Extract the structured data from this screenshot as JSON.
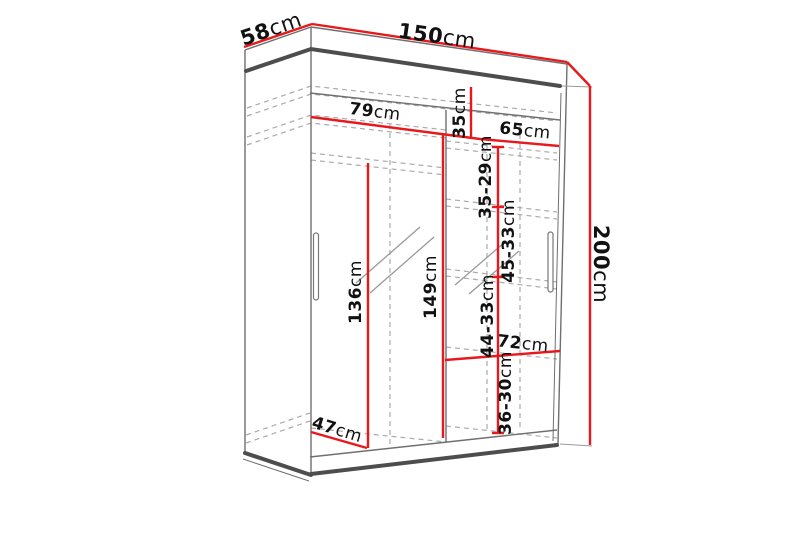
{
  "diagram": {
    "subject": "sliding-door wardrobe dimension drawing",
    "background": "#ffffff",
    "accent_color": "#e8191c",
    "line_color": "#6f6f6f",
    "unit": "cm",
    "dimensions": [
      {
        "id": "depth-top",
        "value": "58",
        "unit": "cm"
      },
      {
        "id": "width-top",
        "value": "150",
        "unit": "cm"
      },
      {
        "id": "height-right",
        "value": "200",
        "unit": "cm"
      },
      {
        "id": "left-section-width",
        "value": "79",
        "unit": "cm"
      },
      {
        "id": "right-section-width",
        "value": "65",
        "unit": "cm"
      },
      {
        "id": "top-shelf-gap",
        "value": "35",
        "unit": "cm"
      },
      {
        "id": "shelf-gap-1",
        "value": "35-29",
        "unit": "cm"
      },
      {
        "id": "shelf-gap-2",
        "value": "45-33",
        "unit": "cm"
      },
      {
        "id": "shelf-gap-3",
        "value": "44-33",
        "unit": "cm"
      },
      {
        "id": "shelf-gap-4",
        "value": "36-30",
        "unit": "cm"
      },
      {
        "id": "left-interior-height",
        "value": "136",
        "unit": "cm"
      },
      {
        "id": "center-interior-height",
        "value": "149",
        "unit": "cm"
      },
      {
        "id": "bottom-shelf-width",
        "value": "72",
        "unit": "cm"
      },
      {
        "id": "interior-depth",
        "value": "47",
        "unit": "cm"
      }
    ]
  }
}
